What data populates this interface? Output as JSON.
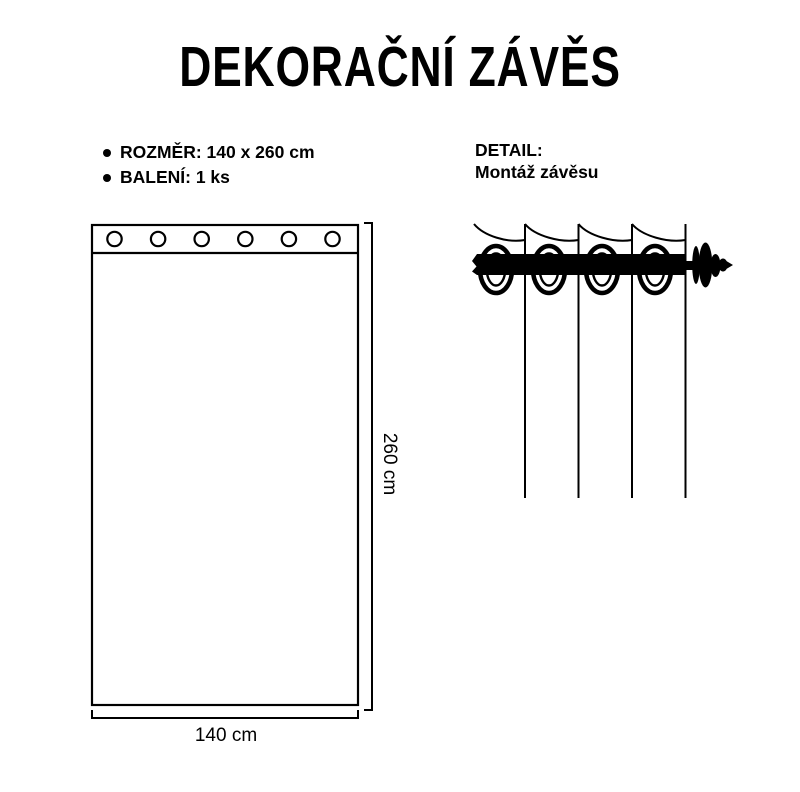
{
  "page": {
    "title": "DEKORAČNÍ ZÁVĚS",
    "background_color": "#ffffff",
    "ink_color": "#000000"
  },
  "specs": {
    "items": [
      {
        "label": "ROZMĚR: 140 x 260 cm"
      },
      {
        "label": "BALENÍ: 1 ks"
      }
    ]
  },
  "detail": {
    "heading": "DETAIL:",
    "subheading": "Montáž závěsu",
    "ring_count": 4
  },
  "curtain": {
    "grommet_count": 6,
    "width_label": "140 cm",
    "height_label": "260 cm"
  }
}
